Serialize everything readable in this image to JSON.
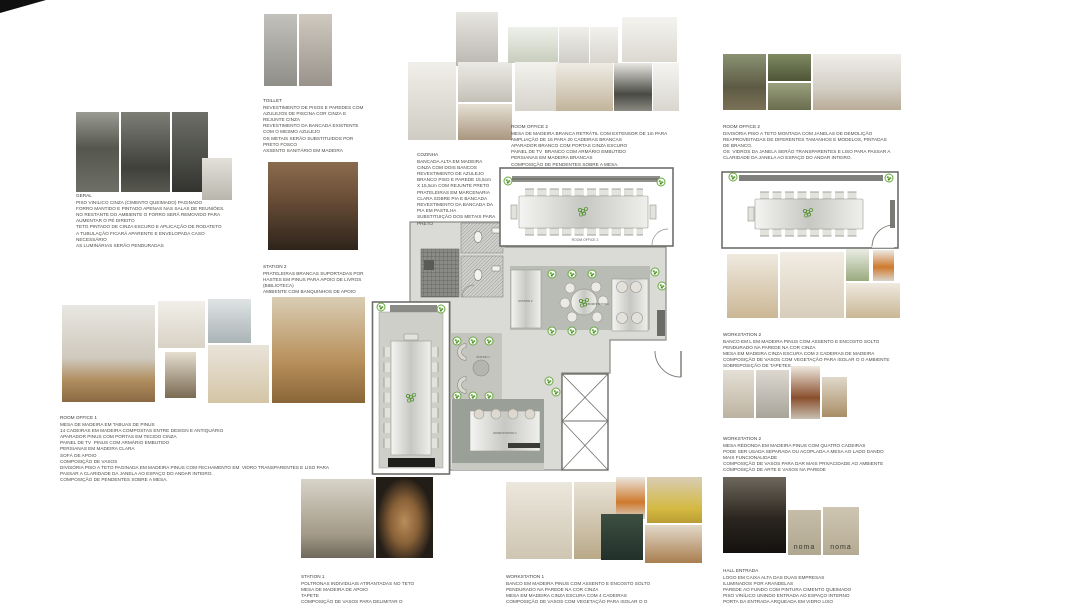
{
  "page": {
    "background": "#ffffff"
  },
  "palette": {
    "plan_floor": "#dadad7",
    "plan_wall": "#6e6e6a",
    "plant_green": "#67a83d",
    "zone_dark": "#9aa098",
    "table_gray": "#c7c7c3"
  },
  "logos": {
    "noma": "noma"
  },
  "floorplan": {
    "labels": {
      "room_office_2": "ROOM OFFICE 2",
      "station_2": "STATION  2",
      "workstation_2": "WORKSTATION  2",
      "station_1": "STATION  1",
      "workstation_1": "WORKSTATION  1"
    }
  },
  "sections": {
    "geral": {
      "title": "GERAL",
      "body": "PISO VINILICO CINZA (CIMENTO QUEIMADO) PAGINADO\nFORRO MANTIDO E PINTADO APENAS NAS SALAS DE REUNIÕES.\nNO RESTANTE DO AMBIENTE O FORRO SERÁ REMOVIDO PARA\nAUMENTAR O PÉ DIREITO\nTETO PINTADO DE CINZA ESCURO E APLICAÇÃO DE RODATETO\nA TUBULAÇÃO FICARÁ APARENTE E ENVELOPADA CASO\nNECESSÁRIO\nAS LUMINÁRIAS SERÃO PENDURADAS"
    },
    "toillet": {
      "title": "TOILLET",
      "body": "REVESTIMENTO DE PISOS E PAREDES COM\nAZULEJOS DE PISCINA COR CINZA E\nREJUNTE CINZA\nREVESTIMENTO DA BANCADA EXISTENTE\nCOM O MESMO AZULEJO\nOS METAIS SERÃO SUBSTITUIDOS POR\nPRETO FOSCO\nASSENTO SANITÁRIO EM MADEIRA"
    },
    "station_2": {
      "title": "STATION 2",
      "body": "PRATELEIRAS BRANCAS SUPORTADAS POR\nHASTES EM PINUS PARA APOIO DE LIVROS\n(BIBLIOTECA)\nAMBIENTE COM BANQUINHOS DE APOIO"
    },
    "cozinha": {
      "title": "COZINHA",
      "body": "BANCADA ALTA EM MADEIRA\nCINZA COM DOIS BANCOS\nREVESTIMENTO DE AZULEJO\nBRANCO PISO E PAREDE 15,5cm\nX 15,5cm COM REJUNTE PRETO\nPRATELEIRAS EM MARCENARIA\nCLARA SOBRE PIA E BANCADA\nREVESTIMENTO DA BANCADA DA\nPIA EM PASTILHA\nSUBSTITUIÇÃO DOS METAIS PARA\nPRETO"
    },
    "room_office_2_center": {
      "title": "ROOM OFFICE 2",
      "body": "MESA DE MADEIRA BRANCA RETRÁTIL COM EXTENSOR DE 1m PARA\nAMPLIAÇÃO DE 16 PARA 20 CADEIRAS BRANCAS\nAPARADOR BRANCO COM PORTAS CINZA ESCURO\nPAINEL DE TV  BRANCO COM ARMÁRIO EMBUTIDO\nPERSIANAS EM MADEIRA BRANCAS\nCOMPOSIÇÃO DE PENDENTES SOBRE A MESA."
    },
    "room_office_2_right": {
      "title": "ROOM OFFICE 2",
      "body": "DIVISÓRIA PISO A TETO MONTADA COM JANELAS DE DEMOLIÇÃO\nREAPROVEITADAS DE DIFERENTES TAMANHOS E MODELOS, PINTADAS\nDE BRANCO.\nOS  VIDROS DA JANELA SERÃO TRANSPARENTES E LISO PARA PASSAR A\nCLARIDADE DA JANELA AO ESPAÇO DO ANDAR INTEIRO."
    },
    "room_office_1": {
      "title": "ROOM OFFICE 1",
      "body": "MESA DE MADEIRA EM TABUAS DE PINUS\n14 CADEIRAS EM MADEIRA COMPOSTAS ENTRE DESIGN E ANTIQUÁRIO\nAPARADOR PINUS COM PORTAS EM TECIDO CINZA\nPAINEL DE TV  PINUS COM ARMÁRIO EMBUTIDO\nPERSIANAS EM MADEIRA CLARA\nSOFÁ DE APOIO\nCOMPOSIÇÃO DE VASOS\nDIVISÓRIA PISO A TETO PAGINADA EM MADEIRA PINUS COM FECHAMENTO EM  VIDRO TRANSPARENTES E LISO PARA\nPASSAR A CLARIDADE DA JANELA AO ESPAÇO DO ANDAR INTEIRO.\nCOMPOSIÇÃO DE PENDENTES SOBRE A MESA."
    },
    "workstation_2_a": {
      "title": "WORKSTATION 2",
      "body": "BANCO EM L EM MADEIRA PINUS COM ASSENTO E ENCOSTO SOLTO\nPENDURADO NA PAREDE NA COR CINZA\nMESA EM MADEIRA CINZA ESCURA COM 2 CADEIRAS DE MADEIRA\nCOMPOSIÇÃO DE VASOS COM VEGETAÇÃO PARA ISOLAR O O AMBIENTE\nSOBREPOSIÇÃO DE TAPETES"
    },
    "workstation_2_b": {
      "title": "WORKSTATION 2",
      "body": "MESA REDONDA EM MADEIRA PINUS COM QUATRO CADEIRAS\nPODE SER USADA SEPARADA OU ACOPLADA A MESA AO LADO DANDO\nMAIS FUNCIONALIDADE\nCOMPOSIÇÃO DE VASOS PARA DAR MAIS PRIVACIDADE AO AMBIENTE\nCOMPOSIÇÃO DE ARTE E VASOS NA PAREDE"
    },
    "station_1": {
      "title": "STATION 1",
      "body": "POLTRONAS INDIVIDUAIS ATIRANTADAS NO TETO\nMESA DE MADEIRA DE APOIO\nTAPETE\nCOMPOSIÇÃO DE VASOS PARA DELIMITAR O"
    },
    "workstation_1": {
      "title": "WORKSTATION 1",
      "body": "BANCO EM MADEIRA PINUS COM ASSENTO E ENCOSTO SOLTO\nPENDURADO NA PAREDE NA COR CINZA\nMESA EM MADEIRA CINZA ESCURA COM 4 CADEIRAS\nCOMPOSIÇÃO DE VASOS COM VEGETAÇÃO PARA ISOLAR O O"
    },
    "hall_entrada": {
      "title": "HALL ENTRADA",
      "body": "LOGO EM CAIXA ALTA DAS DUAS EMPRESAS\nILUMINADOS POR ARANDELAS\nPAREDE AO FUNDO COM PINTURA CIMENTO QUEIMADO\nPISO VINÍLICO UNINDO ENTRADA AO ESPAÇO INTERNO\nPORTA DA ENTRADA ARQUEADA EM VIDRO LISO"
    }
  }
}
